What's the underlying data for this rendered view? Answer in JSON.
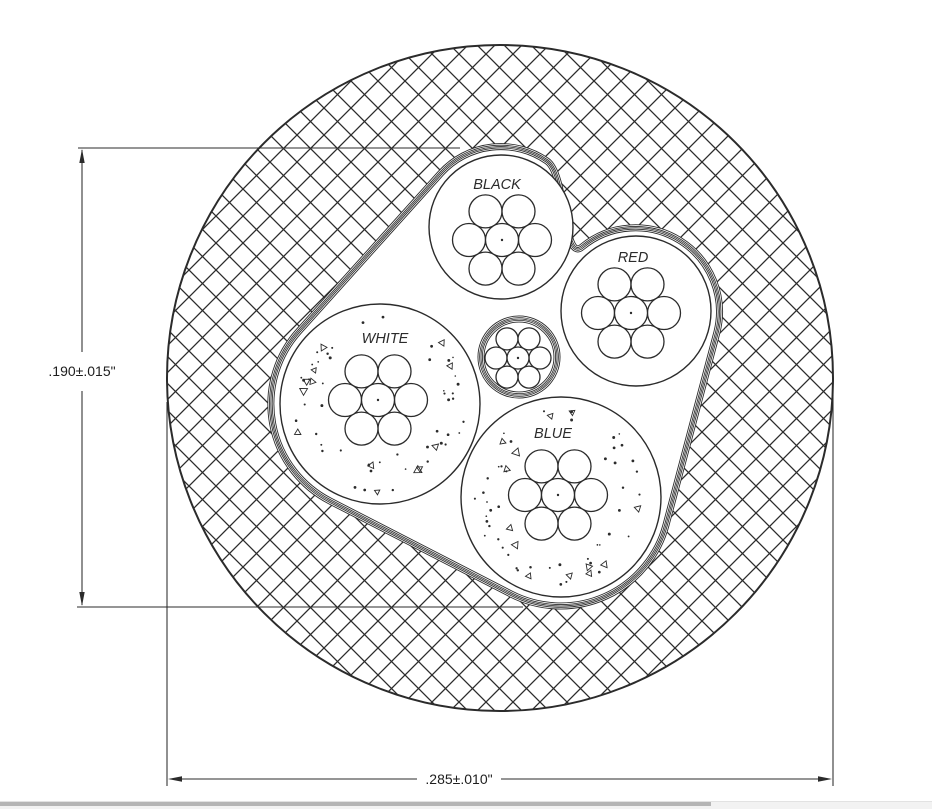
{
  "diagram": {
    "type": "cable-cross-section",
    "conductors": [
      {
        "id": "black",
        "label": "BLACK"
      },
      {
        "id": "red",
        "label": "RED"
      },
      {
        "id": "white",
        "label": "WHITE"
      },
      {
        "id": "blue",
        "label": "BLUE"
      }
    ],
    "drain_wire_strands": 7,
    "conductor_strands": 7,
    "dimensions": {
      "core_height": ".190±.015\"",
      "overall_diameter": ".285±.010\""
    },
    "colors": {
      "line": "#2b2b2b",
      "background": "#ffffff",
      "scrollbar_track": "#f2f2f2",
      "scrollbar_thumb": "#b5b5b5"
    }
  }
}
